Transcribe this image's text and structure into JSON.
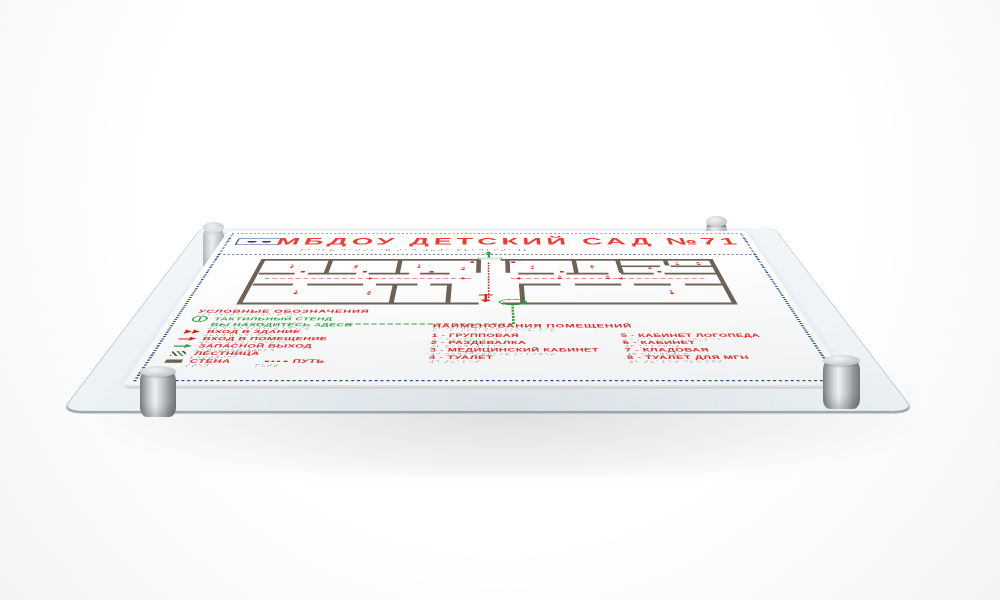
{
  "scene": {
    "description": "3D render of a tactile evacuation-plan board on clear acrylic with four metal standoffs",
    "colors": {
      "accent_red": "#e2251d",
      "accent_green": "#2ea43c",
      "frame_navy": "#2b4f90",
      "wall_brown": "#6e6156",
      "plate_white": "#ffffff"
    }
  },
  "title": {
    "text": "МБДОУ  ДЕТСКИЙ  САД  №71",
    "braille": "⠍⠃⠙⠕⠥  ⠙⠑⠞⠎⠅⠊⠯  ⠎⠁⠙  ⠼⠶⠼⠁  ⠏⠗⠑⠙⠕⠎⠞⠁⠺⠇"
  },
  "legend": {
    "heading": "УСЛОВНЫЕ ОБОЗНАЧЕНИЯ",
    "heading_braille": "⠥⠎⠇⠕⠺⠝⠾⠑ ⠕⠃⠕⠵⠝⠁⠟⠑⠝⠊⠫",
    "items": [
      {
        "icon": "tactile-stand-icon",
        "label": "ТАКТИЛЬНЫЙ СТЕНД",
        "braille": "⠞⠁⠅⠞⠊⠇⠾⠝⠾⠯ ⠎⠞⠑⠝⠙",
        "color": "green"
      },
      {
        "icon": "you-are-here-dashed-line",
        "label": "ВЫ НАХОДИТЕСЬ ЗДЕСЬ",
        "braille": "⠺⠾ ⠝⠁⠓⠕⠙⠊⠞⠑⠎⠾ ⠵⠙⠑⠎⠾",
        "color": "green"
      },
      {
        "icon": "building-entrance-icon",
        "label": "ВХОД В ЗДАНИЕ",
        "braille": "⠺⠓⠕⠙ ⠺ ⠵⠙⠁⠝⠊⠑",
        "color": "red"
      },
      {
        "icon": "room-entrance-icon",
        "label": "ВХОД В ПОМЕЩЕНИЕ",
        "braille": "⠺⠓⠕⠙ ⠺ ⠏⠕⠍⠑⠭⠑⠝⠊⠑",
        "color": "red"
      },
      {
        "icon": "emergency-exit-icon",
        "label": "ЗАПАСНОЙ ВЫХОД",
        "braille": "⠵⠁⠏⠁⠎⠝⠕⠯ ⠺⠾⠓⠕⠙",
        "color": "red"
      },
      {
        "icon": "stairs-icon",
        "label": "ЛЕСТНИЦА",
        "braille": "⠇⠑⠎⠞⠝⠊⠉⠁",
        "color": "red"
      },
      {
        "icon": "wall-swatch-icon",
        "label": "СТЕНА",
        "braille": "⠎⠞⠑⠝⠁",
        "color": "red"
      },
      {
        "icon": "path-line-icon",
        "label": "ПУТЬ",
        "braille": "⠏⠥⠞⠾",
        "color": "red"
      }
    ]
  },
  "rooms": {
    "heading": "НАИМЕНОВАНИЯ ПОМЕЩЕНИЙ",
    "heading_braille": "⠝⠁⠊⠍⠑⠝⠕⠺⠁⠝⠊⠫ ⠏⠕⠍⠑⠭⠑⠝⠊⠯",
    "list1": [
      {
        "text": "1 - ГРУППОВАЯ",
        "braille": "⠼⠁ ⠛⠗⠥⠏⠏⠕⠺⠁⠫"
      },
      {
        "text": "2 - РАЗДЕВАЛКА",
        "braille": "⠼⠃ ⠗⠁⠵⠙⠑⠺⠁⠇⠅⠁"
      },
      {
        "text": "3 - МЕДИЦИНСКИЙ КАБИНЕТ",
        "braille": "⠼⠉ ⠍⠑⠙⠊⠉⠊⠝⠎⠅⠊⠯ ⠅⠁⠃⠊⠝⠑⠞"
      },
      {
        "text": "4 - ТУАЛЕТ",
        "braille": "⠼⠙ ⠞⠥⠁⠇⠑⠞"
      }
    ],
    "list2": [
      {
        "text": "5 - КАБИНЕТ ЛОГОПЕДА",
        "braille": "⠼⠑ ⠅⠁⠃⠊⠝⠑⠞ ⠇⠕⠛⠕⠏⠑⠙⠁"
      },
      {
        "text": "6 - КАБИНЕТ",
        "braille": "⠼⠋ ⠅⠁⠃⠊⠝⠑⠞"
      },
      {
        "text": "7 - КЛАДОВАЯ",
        "braille": "⠼⠛ ⠅⠇⠁⠙⠕⠺⠁⠫"
      },
      {
        "text": "8 - ТУАЛЕТ ДЛЯ МГН",
        "braille": "⠼⠓ ⠞⠥⠁⠇⠑⠞ ⠙⠇⠫ ⠍⠛⠝"
      }
    ]
  },
  "plan": {
    "markers": [
      {
        "n": "1"
      },
      {
        "n": "2"
      },
      {
        "n": "1"
      },
      {
        "n": "1"
      },
      {
        "n": "2"
      },
      {
        "n": "3"
      },
      {
        "n": "4"
      },
      {
        "n": "2"
      },
      {
        "n": "5"
      },
      {
        "n": "7"
      },
      {
        "n": "8"
      },
      {
        "n": "6"
      },
      {
        "n": "1"
      },
      {
        "n": "3"
      }
    ]
  }
}
